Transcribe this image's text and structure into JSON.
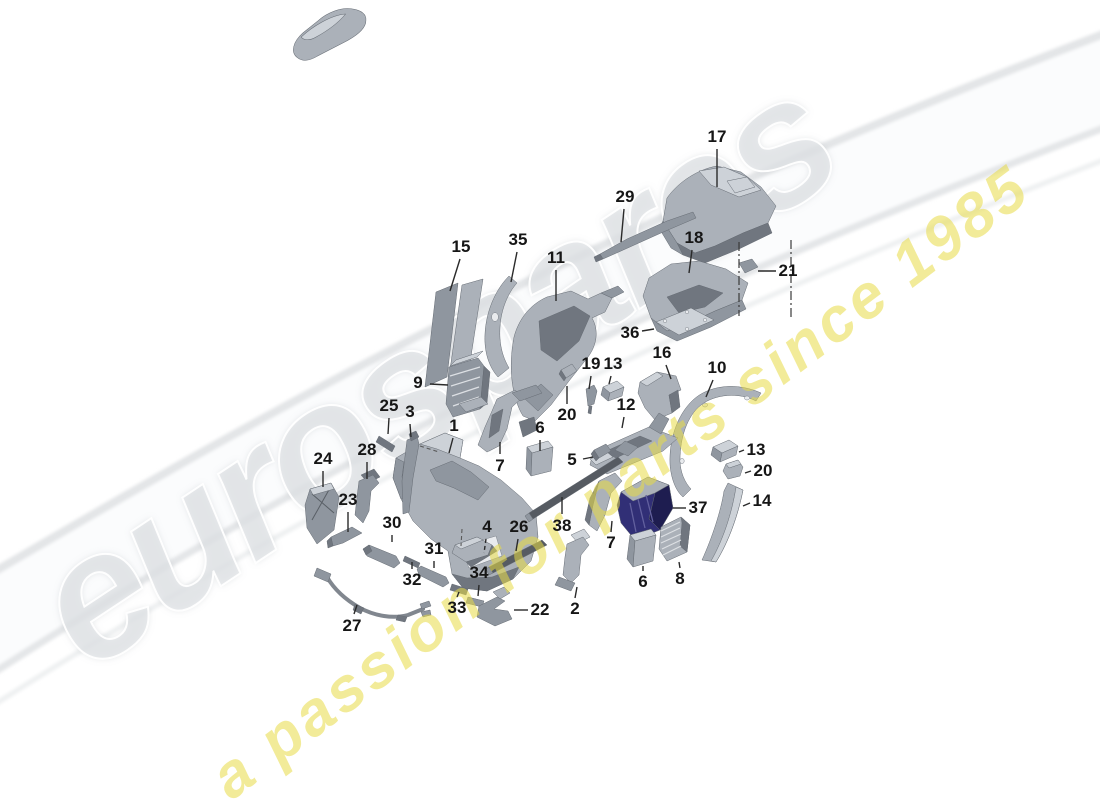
{
  "watermark": {
    "brand": "eurospares",
    "tagline": "a passion for parts since 1985",
    "tagline_color": "#e8db46",
    "brand_color": "#e2e5e8"
  },
  "colors": {
    "part_highlight_navy": "#2c2b68",
    "part_gray": "#abb1b9",
    "label_color": "#161616"
  },
  "diagram": {
    "callouts": [
      {
        "id": "17",
        "label": "17",
        "x": 717,
        "y": 137,
        "x1": 717,
        "y1": 149,
        "x2": 717,
        "y2": 187,
        "style": "solid"
      },
      {
        "id": "29",
        "label": "29",
        "x": 625,
        "y": 197,
        "x1": 624,
        "y1": 209,
        "x2": 621,
        "y2": 242,
        "style": "solid"
      },
      {
        "id": "18",
        "label": "18",
        "x": 694,
        "y": 238,
        "x1": 692,
        "y1": 250,
        "x2": 689,
        "y2": 273,
        "style": "solid"
      },
      {
        "id": "21",
        "label": "21",
        "x": 788,
        "y": 271,
        "x1": 776,
        "y1": 271,
        "x2": 758,
        "y2": 271,
        "style": "solid"
      },
      {
        "id": "36",
        "label": "36",
        "x": 630,
        "y": 333,
        "x1": 642,
        "y1": 331,
        "x2": 654,
        "y2": 329,
        "style": "solid"
      },
      {
        "id": "15",
        "label": "15",
        "x": 461,
        "y": 247,
        "x1": 460,
        "y1": 259,
        "x2": 450,
        "y2": 291,
        "style": "solid"
      },
      {
        "id": "35",
        "label": "35",
        "x": 518,
        "y": 240,
        "x1": 517,
        "y1": 252,
        "x2": 511,
        "y2": 282,
        "style": "solid"
      },
      {
        "id": "11",
        "label": "11",
        "x": 556,
        "y": 258,
        "x1": 556,
        "y1": 270,
        "x2": 556,
        "y2": 301,
        "style": "solid"
      },
      {
        "id": "9",
        "label": "9",
        "x": 418,
        "y": 383,
        "x1": 430,
        "y1": 384,
        "x2": 448,
        "y2": 385,
        "style": "solid"
      },
      {
        "id": "25",
        "label": "25",
        "x": 389,
        "y": 406,
        "x1": 389,
        "y1": 418,
        "x2": 388,
        "y2": 434,
        "style": "solid"
      },
      {
        "id": "3",
        "label": "3",
        "x": 410,
        "y": 412,
        "x1": 410,
        "y1": 424,
        "x2": 411,
        "y2": 437,
        "style": "solid"
      },
      {
        "id": "1",
        "label": "1",
        "x": 454,
        "y": 426,
        "x1": 453,
        "y1": 438,
        "x2": 449,
        "y2": 453,
        "style": "solid"
      },
      {
        "id": "19",
        "label": "19",
        "x": 591,
        "y": 364,
        "x1": 591,
        "y1": 376,
        "x2": 589,
        "y2": 389,
        "style": "solid"
      },
      {
        "id": "13a",
        "label": "13",
        "x": 613,
        "y": 364,
        "x1": 611,
        "y1": 376,
        "x2": 609,
        "y2": 384,
        "style": "solid"
      },
      {
        "id": "16",
        "label": "16",
        "x": 662,
        "y": 353,
        "x1": 666,
        "y1": 365,
        "x2": 671,
        "y2": 379,
        "style": "solid"
      },
      {
        "id": "10",
        "label": "10",
        "x": 717,
        "y": 368,
        "x1": 713,
        "y1": 380,
        "x2": 706,
        "y2": 397,
        "style": "solid"
      },
      {
        "id": "12",
        "label": "12",
        "x": 626,
        "y": 405,
        "x1": 624,
        "y1": 417,
        "x2": 622,
        "y2": 428,
        "style": "solid"
      },
      {
        "id": "20a",
        "label": "20",
        "x": 567,
        "y": 415,
        "x1": 567,
        "y1": 404,
        "x2": 567,
        "y2": 386,
        "style": "solid"
      },
      {
        "id": "6a",
        "label": "6",
        "x": 540,
        "y": 428,
        "x1": 540,
        "y1": 440,
        "x2": 540,
        "y2": 451,
        "style": "solid"
      },
      {
        "id": "5",
        "label": "5",
        "x": 572,
        "y": 460,
        "x1": 583,
        "y1": 459,
        "x2": 593,
        "y2": 457,
        "style": "solid"
      },
      {
        "id": "7a",
        "label": "7",
        "x": 500,
        "y": 466,
        "x1": 500,
        "y1": 454,
        "x2": 500,
        "y2": 442,
        "style": "solid"
      },
      {
        "id": "24",
        "label": "24",
        "x": 323,
        "y": 459,
        "x1": 323,
        "y1": 471,
        "x2": 323,
        "y2": 487,
        "style": "solid"
      },
      {
        "id": "28",
        "label": "28",
        "x": 367,
        "y": 450,
        "x1": 367,
        "y1": 462,
        "x2": 367,
        "y2": 479,
        "style": "solid"
      },
      {
        "id": "23",
        "label": "23",
        "x": 348,
        "y": 500,
        "x1": 348,
        "y1": 512,
        "x2": 348,
        "y2": 532,
        "style": "solid"
      },
      {
        "id": "30",
        "label": "30",
        "x": 392,
        "y": 523,
        "x1": 392,
        "y1": 535,
        "x2": 392,
        "y2": 542,
        "style": "solid"
      },
      {
        "id": "37",
        "label": "37",
        "x": 698,
        "y": 508,
        "x1": 686,
        "y1": 508,
        "x2": 673,
        "y2": 508,
        "style": "solid"
      },
      {
        "id": "14",
        "label": "14",
        "x": 762,
        "y": 501,
        "x1": 750,
        "y1": 503,
        "x2": 743,
        "y2": 506,
        "style": "solid"
      },
      {
        "id": "13b",
        "label": "13",
        "x": 756,
        "y": 450,
        "x1": 744,
        "y1": 450,
        "x2": 739,
        "y2": 452,
        "style": "solid"
      },
      {
        "id": "20b",
        "label": "20",
        "x": 763,
        "y": 471,
        "x1": 751,
        "y1": 471,
        "x2": 745,
        "y2": 473,
        "style": "solid"
      },
      {
        "id": "38",
        "label": "38",
        "x": 562,
        "y": 526,
        "x1": 562,
        "y1": 514,
        "x2": 562,
        "y2": 497,
        "style": "solid"
      },
      {
        "id": "26",
        "label": "26",
        "x": 519,
        "y": 527,
        "x1": 518,
        "y1": 539,
        "x2": 516,
        "y2": 551,
        "style": "solid"
      },
      {
        "id": "4",
        "label": "4",
        "x": 487,
        "y": 527,
        "x1": 486,
        "y1": 539,
        "x2": 484,
        "y2": 553,
        "style": "dashed"
      },
      {
        "id": "31",
        "label": "31",
        "x": 434,
        "y": 549,
        "x1": 434,
        "y1": 561,
        "x2": 434,
        "y2": 568,
        "style": "solid"
      },
      {
        "id": "32",
        "label": "32",
        "x": 412,
        "y": 580,
        "x1": 412,
        "y1": 569,
        "x2": 412,
        "y2": 562,
        "style": "solid"
      },
      {
        "id": "34",
        "label": "34",
        "x": 479,
        "y": 573,
        "x1": 479,
        "y1": 585,
        "x2": 478,
        "y2": 596,
        "style": "solid"
      },
      {
        "id": "33",
        "label": "33",
        "x": 457,
        "y": 608,
        "x1": 457,
        "y1": 597,
        "x2": 459,
        "y2": 592,
        "style": "solid"
      },
      {
        "id": "27",
        "label": "27",
        "x": 352,
        "y": 626,
        "x1": 354,
        "y1": 614,
        "x2": 357,
        "y2": 605,
        "style": "solid"
      },
      {
        "id": "22",
        "label": "22",
        "x": 540,
        "y": 610,
        "x1": 528,
        "y1": 610,
        "x2": 514,
        "y2": 610,
        "style": "solid"
      },
      {
        "id": "2",
        "label": "2",
        "x": 575,
        "y": 609,
        "x1": 575,
        "y1": 598,
        "x2": 577,
        "y2": 587,
        "style": "solid"
      },
      {
        "id": "7b",
        "label": "7",
        "x": 611,
        "y": 543,
        "x1": 611,
        "y1": 532,
        "x2": 612,
        "y2": 521,
        "style": "solid"
      },
      {
        "id": "6b",
        "label": "6",
        "x": 643,
        "y": 582,
        "x1": 643,
        "y1": 571,
        "x2": 643,
        "y2": 566,
        "style": "solid"
      },
      {
        "id": "8",
        "label": "8",
        "x": 680,
        "y": 579,
        "x1": 680,
        "y1": 568,
        "x2": 679,
        "y2": 562,
        "style": "solid"
      }
    ],
    "construction_lines": [
      {
        "x1": 739,
        "y1": 242,
        "x2": 739,
        "y2": 316
      },
      {
        "x1": 791,
        "y1": 240,
        "x2": 791,
        "y2": 318
      }
    ],
    "connector_dashes": [
      {
        "x1": 420,
        "y1": 446,
        "x2": 439,
        "y2": 452
      },
      {
        "x1": 462,
        "y1": 529,
        "x2": 461,
        "y2": 546
      }
    ]
  }
}
